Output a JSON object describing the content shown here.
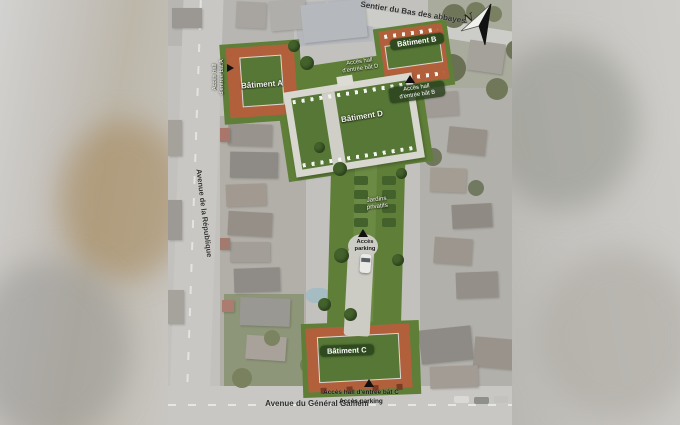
{
  "streets": {
    "top": "Sentier du Bas des abbayes",
    "left": "Avenue de la République",
    "bottom": "Avenue du Général Galliéni"
  },
  "buildings": {
    "a": {
      "label": "Bâtiment A"
    },
    "b": {
      "label": "Bâtiment B"
    },
    "c": {
      "label": "Bâtiment C"
    },
    "d": {
      "label": "Bâtiment D"
    }
  },
  "annotations": {
    "access_hall_a": {
      "line1": "Accès hall",
      "line2": "d'entrée bât A"
    },
    "access_hall_b": {
      "line1": "Accès hall",
      "line2": "d'entrée bât B"
    },
    "access_hall_d": {
      "line1": "Accès hall",
      "line2": "d'entrée bât D"
    },
    "gardens": {
      "line1": "Jardins",
      "line2": "privatifs"
    },
    "access_parking_mid": {
      "line1": "Accès",
      "line2": "parking"
    },
    "access_hall_c": "Accès hall d'entrée bât C",
    "access_parking_c": "Accès parking"
  },
  "compass": {
    "north": "N"
  },
  "colors": {
    "site_green": "#5f7f39",
    "site_green_light": "#6b8a44",
    "hedge_green": "#43612b",
    "building_orange": "#b2603b",
    "building_d_gray": "#d7d6cf",
    "courtyard_green": "#567736",
    "label_pill_green": "#2f4a1f"
  }
}
